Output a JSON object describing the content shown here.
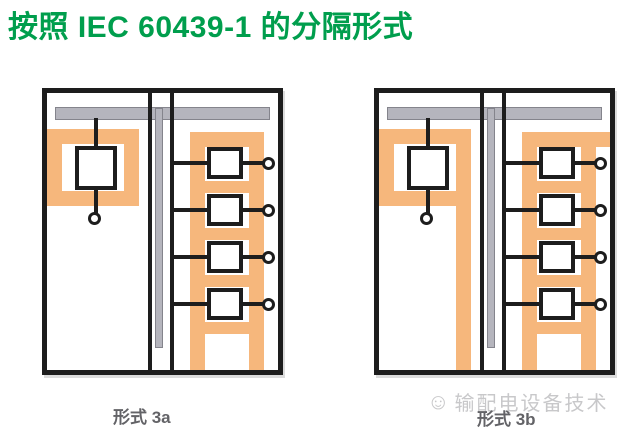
{
  "title": {
    "text": "按照 IEC 60439-1 的分隔形式"
  },
  "diagrams": [
    {
      "label": "形式 3a",
      "incoming_units": 1,
      "outgoing_units": 4,
      "separation": "incoming device enclosed by closed orange partition ring; outgoing ladder top band stops at inner bar"
    },
    {
      "label": "形式 3b",
      "incoming_units": 1,
      "outgoing_units": 4,
      "separation": "incoming partition right band extends to cabinet bottom; outgoing ladder top band extends to cabinet wall"
    }
  ],
  "watermark": {
    "icon": "smiley-emoji",
    "text": "输配电设备技术"
  },
  "colors": {
    "green": "#009E4D",
    "orange": "#F6B77C",
    "bus": "#B5B5BD",
    "bus_border": "#84848C",
    "line": "#1D1D1D",
    "label_gray": "#636367",
    "wm_gray": "#C8C8CA"
  }
}
